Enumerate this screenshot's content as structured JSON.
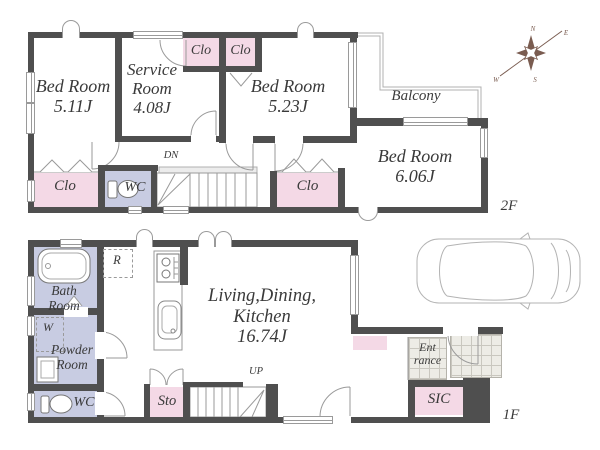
{
  "colors": {
    "wall": "#4f4f4f",
    "closet_pink": "#f4d9e6",
    "sanitary_lavender": "#c8cce2",
    "thin_line": "#9a9a9a",
    "tile": "#edece6"
  },
  "compass": {
    "n": "N",
    "e": "E",
    "s": "S",
    "w": "W"
  },
  "icons": {
    "compass": "compass-rose",
    "car": "car-top-view",
    "bathtub": "bathtub",
    "toilet": "toilet",
    "stove": "stove-burners",
    "kitchen_sink": "kitchen-sink",
    "vanity": "vanity-cabinet",
    "washer_box": "washing-machine-dashed",
    "fridge_box": "refrigerator-dashed",
    "stairs": "staircase",
    "door": "door-swing-arc",
    "window": "window-marker",
    "bifold": "bifold-closet-door"
  },
  "floor2": {
    "floor_label": "2F",
    "bedroom_a": {
      "line1": "Bed Room",
      "line2": "5.11J"
    },
    "service_room": {
      "line1": "Service",
      "line2": "Room",
      "line3": "4.08J"
    },
    "closet_top_left": "Clo",
    "closet_top_right": "Clo",
    "bedroom_b": {
      "line1": "Bed Room",
      "line2": "5.23J"
    },
    "balcony": "Balcony",
    "bedroom_c": {
      "line1": "Bed Room",
      "line2": "6.06J"
    },
    "closet_left": "Clo",
    "toilet": "WC",
    "stairs": "DN",
    "closet_hall": "Clo"
  },
  "floor1": {
    "floor_label": "1F",
    "bathroom": {
      "line1": "Bath",
      "line2": "Room"
    },
    "washer": "W",
    "powder_room": {
      "line1": "Powder",
      "line2": "Room"
    },
    "toilet": "WC",
    "refrigerator": "R",
    "ldk": {
      "line1": "Living,Dining,",
      "line2": "Kitchen",
      "line3": "16.74J"
    },
    "storage": "Sto",
    "stairs": "UP",
    "entrance": {
      "line1": "Ent",
      "line2": "rance"
    },
    "shoe_closet": "SIC"
  }
}
